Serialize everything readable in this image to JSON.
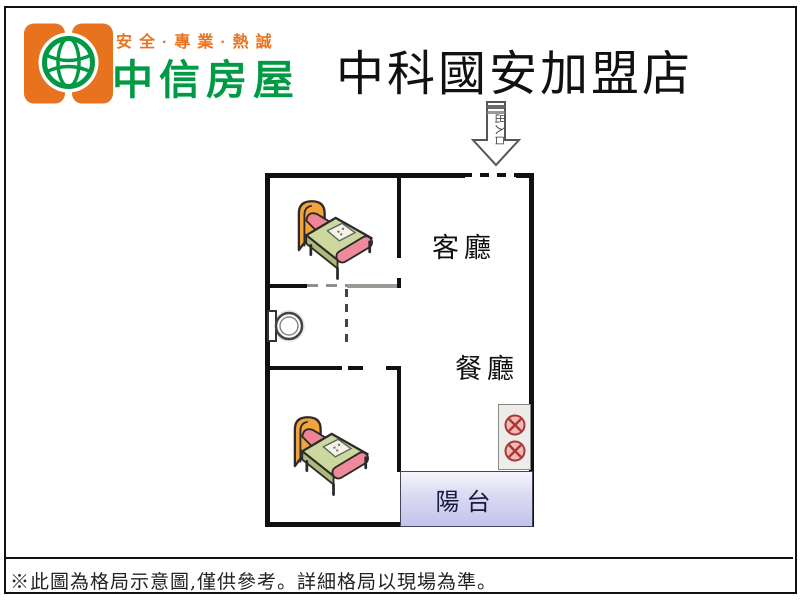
{
  "brand": {
    "slogan": "安全·專業·熱誠",
    "name": "中信房屋"
  },
  "header": {
    "store_title": "中科國安加盟店"
  },
  "plan": {
    "entrance_label": "出入口",
    "living_room_label": "客廳",
    "dining_room_label": "餐廳",
    "balcony_label": "陽台",
    "fixtures": [
      "bed-bedroom-1",
      "bed-bedroom-2",
      "toilet",
      "stove-two-burners"
    ]
  },
  "footer": {
    "disclaimer": "※此圖為格局示意圖,僅供參考。詳細格局以現場為準。"
  },
  "colors": {
    "brand_orange": "#e8731e",
    "brand_green": "#009a44",
    "wall_black": "#111111",
    "balcony_fill": "#c3c3ec",
    "burner_red": "#a83838",
    "bed_blanket_green": "#ccd89e",
    "bed_headboard_orange": "#f3a33c",
    "bed_pillow_pink": "#ee8494"
  }
}
